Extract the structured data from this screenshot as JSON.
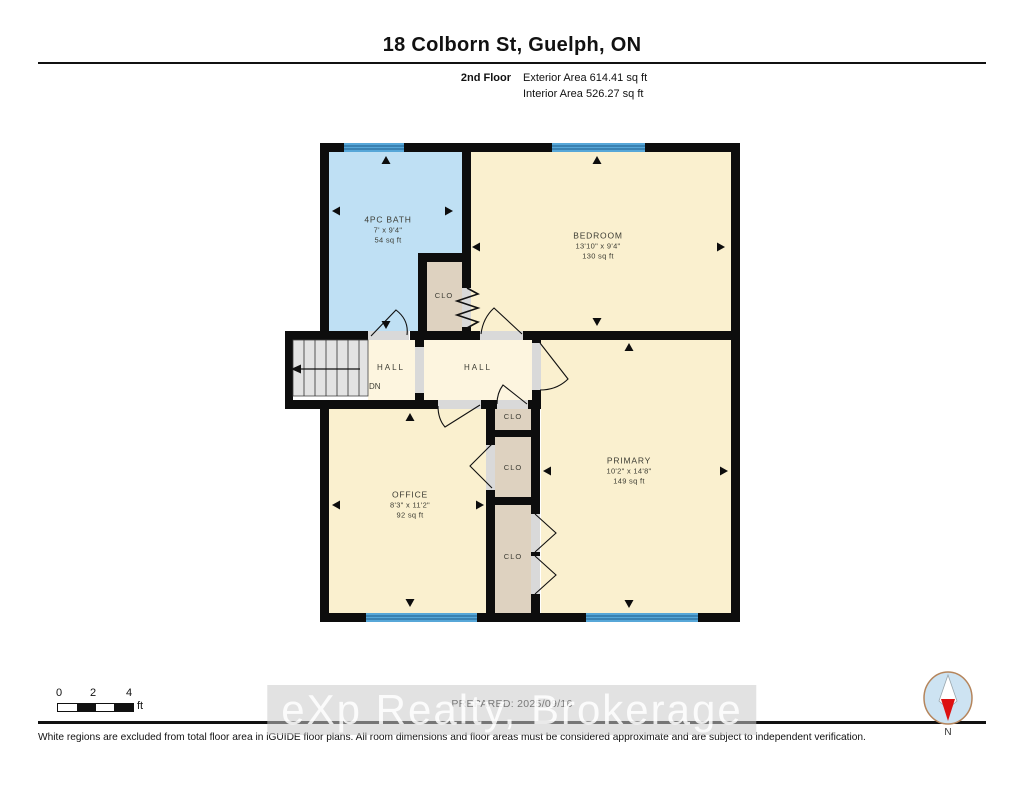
{
  "header": {
    "title": "18 Colborn St, Guelph, ON",
    "floor_label": "2nd Floor",
    "exterior_area": "Exterior Area 614.41 sq ft",
    "interior_area": "Interior Area 526.27 sq ft"
  },
  "plan": {
    "bath": {
      "name": "4PC BATH",
      "dims": "7' x 9'4\"",
      "area": "54 sq ft"
    },
    "bedroom": {
      "name": "BEDROOM",
      "dims": "13'10\" x 9'4\"",
      "area": "130 sq ft"
    },
    "office": {
      "name": "OFFICE",
      "dims": "8'3\" x 11'2\"",
      "area": "92 sq ft"
    },
    "primary": {
      "name": "PRIMARY",
      "dims": "10'2\" x 14'8\"",
      "area": "149 sq ft"
    },
    "hall1": {
      "name": "HALL",
      "down_label": "DN"
    },
    "hall2": {
      "name": "HALL"
    },
    "closet_bedroom": {
      "name": "CLO"
    },
    "closet_a": {
      "name": "CLO"
    },
    "closet_b": {
      "name": "CLO"
    },
    "closet_c": {
      "name": "CLO"
    }
  },
  "scale_bar": {
    "ticks": [
      "0",
      "2",
      "4"
    ],
    "unit": "ft"
  },
  "footer": {
    "prepared": "PREPARED: 2025/09/16",
    "disclaimer": "White regions are excluded from total floor area in iGUIDE floor plans. All room dimensions and floor areas must be considered approximate and are subject to independent verification."
  },
  "watermark": {
    "text": "eXp Realty, Brokerage"
  },
  "compass": {
    "label": "N"
  },
  "colors": {
    "wall": "#0d0d0d",
    "bath_fill": "#bfe0f4",
    "room_fill": "#faf0cf",
    "hall_fill": "#fdf5df",
    "closet_fill": "#ded2c0",
    "window_blue": "#57a7d8",
    "stairs_gray": "#e3e3e3",
    "compass_needle_red": "#dd1111"
  }
}
